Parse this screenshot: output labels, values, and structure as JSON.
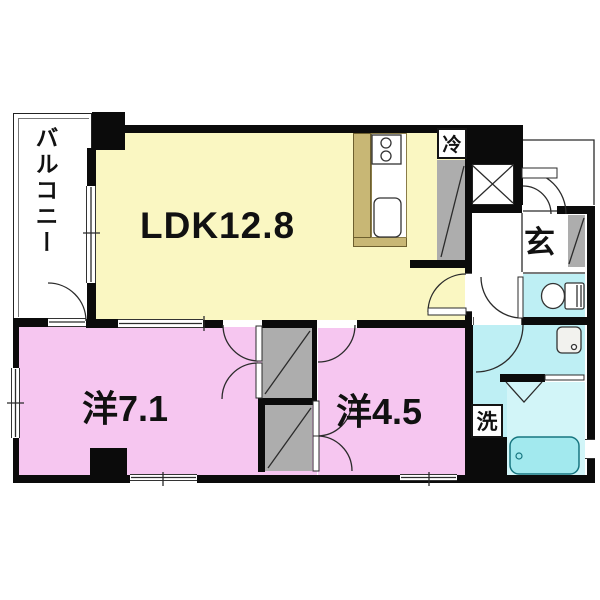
{
  "floorplan": {
    "type": "apartment-madori",
    "rooms": {
      "balcony": {
        "label": "バルコニー"
      },
      "ldk": {
        "label": "LDK12.8"
      },
      "western1": {
        "label": "洋7.1"
      },
      "western2": {
        "label": "洋4.5"
      },
      "entrance": {
        "label": "玄"
      }
    },
    "fixtures": {
      "refrigerator": {
        "label": "冷"
      },
      "washer": {
        "label": "洗"
      }
    }
  },
  "colors": {
    "ldk": "#FAF7C2",
    "bedroom": "#F6C6F0",
    "wet": "#BEEFF4",
    "bathfloor": "#D2F5F8",
    "tub": "#A2E9EE",
    "counter": "#C8B775",
    "closet": "#ADADAD",
    "wall": "#0B0B0B"
  }
}
